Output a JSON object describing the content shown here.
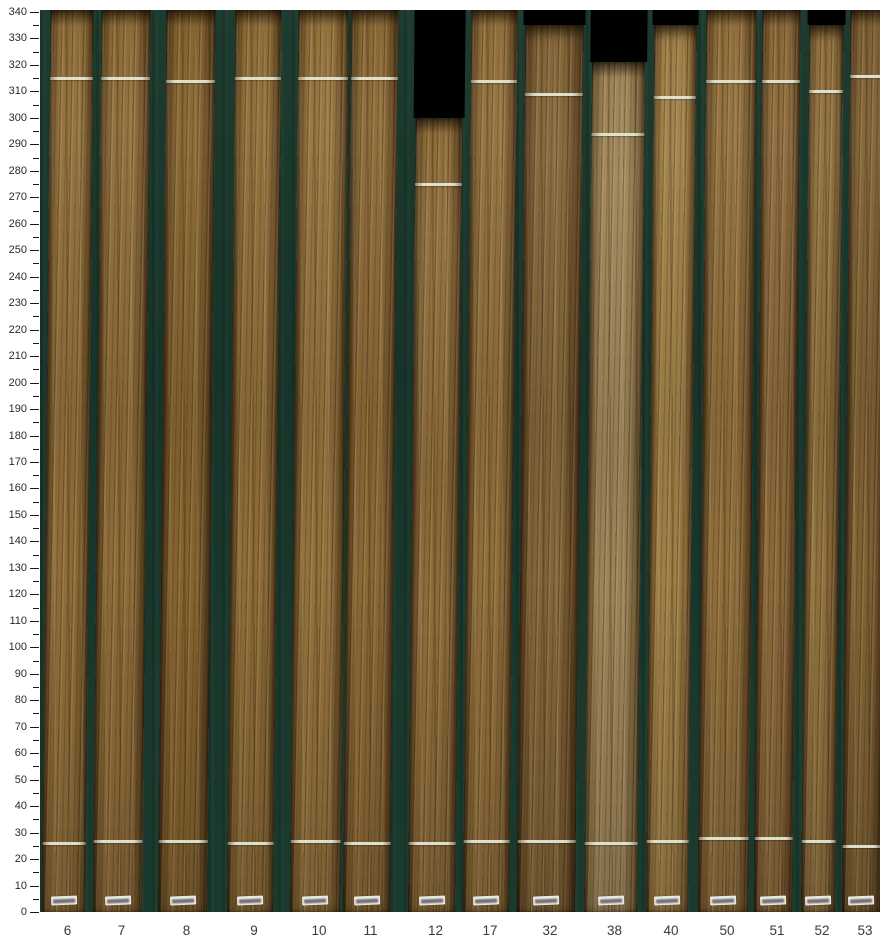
{
  "figure": {
    "background_color": "#ffffff",
    "plot_background_color": "#1b382c",
    "cutout_color": "#000000",
    "mark_color": "#dfe5d3",
    "axis_text_color": "#2b2b2b"
  },
  "y_axis": {
    "min": 0,
    "max": 340,
    "major_step": 10,
    "minor_step": 5,
    "tick_labels": [
      "0",
      "10",
      "20",
      "30",
      "40",
      "50",
      "60",
      "70",
      "80",
      "90",
      "100",
      "110",
      "120",
      "130",
      "140",
      "150",
      "160",
      "170",
      "180",
      "190",
      "200",
      "210",
      "220",
      "230",
      "240",
      "250",
      "260",
      "270",
      "280",
      "290",
      "300",
      "310",
      "320",
      "330",
      "340"
    ]
  },
  "chart_data": {
    "type": "bar",
    "title": "",
    "xlabel": "",
    "ylabel": "",
    "ylim": [
      0,
      340
    ],
    "categories": [
      "6",
      "7",
      "8",
      "9",
      "10",
      "11",
      "12",
      "17",
      "32",
      "38",
      "40",
      "50",
      "51",
      "52",
      "53"
    ],
    "series": [
      {
        "name": "board visible top (scale units)",
        "values": [
          340,
          340,
          340,
          340,
          340,
          340,
          300,
          340,
          335,
          321,
          335,
          340,
          340,
          335,
          340
        ]
      },
      {
        "name": "upper white mark position",
        "values": [
          315,
          315,
          314,
          315,
          315,
          315,
          275,
          314,
          309,
          294,
          308,
          314,
          314,
          310,
          316
        ]
      },
      {
        "name": "lower white mark position",
        "values": [
          26,
          27,
          27,
          26,
          27,
          26,
          26,
          27,
          27,
          26,
          27,
          28,
          28,
          27,
          25
        ]
      }
    ],
    "legend": [],
    "grid": false
  },
  "boards": [
    {
      "label": "6",
      "left": 42,
      "width": 43,
      "top": 340,
      "marks": [
        315,
        26
      ],
      "dark": "#5e4420",
      "light": "#8f6d3a"
    },
    {
      "label": "7",
      "left": 93,
      "width": 49,
      "top": 340,
      "marks": [
        315,
        27
      ],
      "dark": "#5c4220",
      "light": "#8d6b39"
    },
    {
      "label": "8",
      "left": 158,
      "width": 49,
      "top": 340,
      "marks": [
        314,
        27
      ],
      "dark": "#543a1c",
      "light": "#84632f"
    },
    {
      "label": "9",
      "left": 227,
      "width": 46,
      "top": 340,
      "marks": [
        315,
        26
      ],
      "dark": "#5e4420",
      "light": "#8d6c38"
    },
    {
      "label": "10",
      "left": 290,
      "width": 50,
      "top": 340,
      "marks": [
        315,
        27
      ],
      "dark": "#604622",
      "light": "#93713d"
    },
    {
      "label": "11",
      "left": 343,
      "width": 47,
      "top": 340,
      "marks": [
        315,
        26
      ],
      "dark": "#5a4020",
      "light": "#8a6836"
    },
    {
      "label": "12",
      "left": 408,
      "width": 47,
      "top": 300,
      "marks": [
        275,
        26
      ],
      "dark": "#5e4424",
      "light": "#8d6c3a"
    },
    {
      "label": "17",
      "left": 463,
      "width": 46,
      "top": 340,
      "marks": [
        314,
        27
      ],
      "dark": "#5e4422",
      "light": "#906e3c"
    },
    {
      "label": "32",
      "left": 517,
      "width": 58,
      "top": 335,
      "marks": [
        309,
        27
      ],
      "dark": "#54391c",
      "light": "#826538"
    },
    {
      "label": "38",
      "left": 584,
      "width": 53,
      "top": 321,
      "marks": [
        294,
        26
      ],
      "dark": "#6a5530",
      "light": "#9d8458"
    },
    {
      "label": "40",
      "left": 646,
      "width": 42,
      "top": 335,
      "marks": [
        308,
        27
      ],
      "dark": "#6b4f26",
      "light": "#9f7f48"
    },
    {
      "label": "50",
      "left": 698,
      "width": 50,
      "top": 340,
      "marks": [
        314,
        28
      ],
      "dark": "#5e4422",
      "light": "#8f6e3c"
    },
    {
      "label": "51",
      "left": 754,
      "width": 38,
      "top": 340,
      "marks": [
        314,
        28
      ],
      "dark": "#563c1e",
      "light": "#8a683a"
    },
    {
      "label": "52",
      "left": 801,
      "width": 34,
      "top": 335,
      "marks": [
        310,
        27
      ],
      "dark": "#5e4625",
      "light": "#8f703e"
    },
    {
      "label": "53",
      "left": 842,
      "width": 38,
      "top": 340,
      "marks": [
        316,
        25
      ],
      "dark": "#523a1e",
      "light": "#7f6134"
    }
  ]
}
